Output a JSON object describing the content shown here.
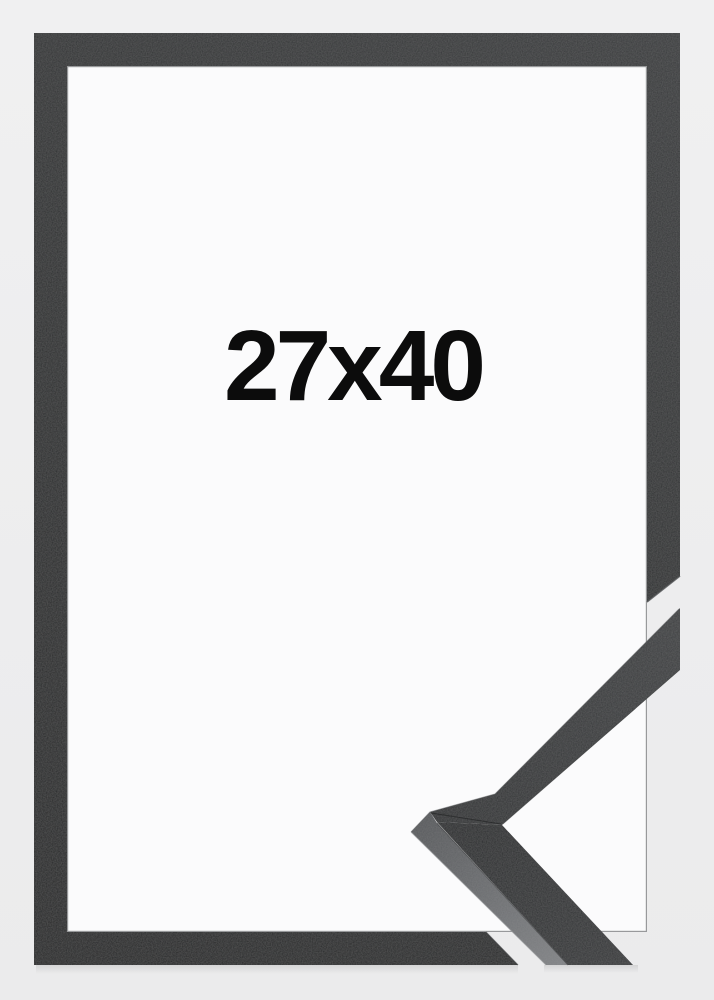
{
  "frame": {
    "size_label": "27x40"
  },
  "colors": {
    "background": "#eeeeef",
    "frame_moulding": "#2a2c2d",
    "frame_opening": "#fbfbfc",
    "label_text": "#0c0c0c",
    "sample_top_face": "#2e3032",
    "sample_side_face": "#6b6d6f"
  }
}
